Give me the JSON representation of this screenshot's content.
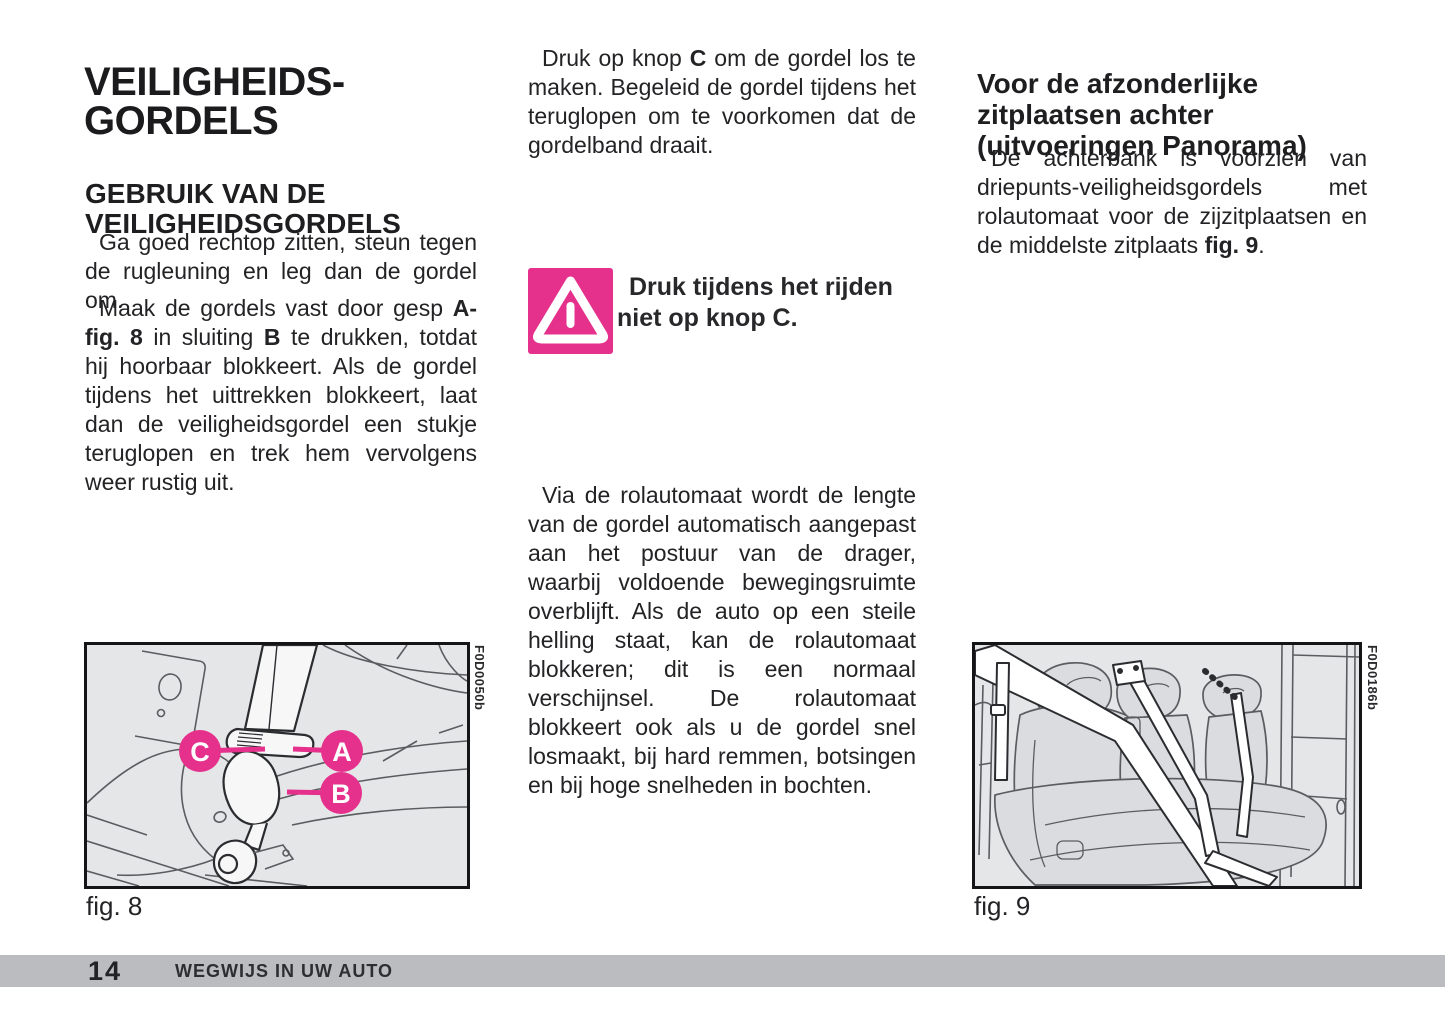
{
  "doc": {
    "left_column": {
      "title": "VEILIGHEIDS-\nGORDELS",
      "section_heading": "GEBRUIK VAN DE\nVEILIGHEIDSGORDELS",
      "paragraph_1": [
        {
          "t": "Ga goed rechtop zitten, steun tegen de rugleuning en leg dan de gordel om."
        }
      ],
      "paragraph_2": [
        {
          "t": "Maak de gordels vast door gesp "
        },
        {
          "t": "A-fig. 8",
          "b": true
        },
        {
          "t": " in sluiting "
        },
        {
          "t": "B",
          "b": true
        },
        {
          "t": " te drukken, totdat hij hoorbaar blokkeert. Als de gordel tijdens het uittrekken blokkeert, laat dan de veiligheidsgordel een stukje teruglopen en trek hem vervolgens weer rustig uit."
        }
      ]
    },
    "middle_column": {
      "paragraph_1": [
        {
          "t": "Druk op knop "
        },
        {
          "t": "C",
          "b": true
        },
        {
          "t": " om de gordel los te maken. Begeleid de gordel tijdens het teruglopen om te voorkomen dat de gordelband draait."
        }
      ],
      "warning_text": "Druk tijdens het rijden\nniet op knop C.",
      "paragraph_2": [
        {
          "t": "Via de rolautomaat wordt de lengte van de gordel automatisch aangepast aan het postuur van de drager, waarbij voldoende bewegingsruimte overblijft. Als de auto op een steile helling staat, kan de rolautomaat blokkeren; dit is een normaal verschijnsel. De rolautomaat blokkeert ook als u de gordel snel losmaakt, bij hard remmen, botsingen en bij hoge snelheden in bochten."
        }
      ]
    },
    "right_column": {
      "heading": "Voor de afzonderlijke\nzitplaatsen achter\n(uitvoeringen Panorama)",
      "paragraph_1": [
        {
          "t": "De achterbank is voorzien van driepunts-veiligheidsgordels met rolautomaat voor de zijzitplaatsen en de middelste zitplaats "
        },
        {
          "t": "fig. 9",
          "b": true
        },
        {
          "t": "."
        }
      ]
    },
    "figures": {
      "fig8": {
        "caption": "fig. 8",
        "code": "F0D0050b",
        "labels": {
          "c": "C",
          "a": "A",
          "b": "B"
        }
      },
      "fig9": {
        "caption": "fig. 9",
        "code": "F0D0186b"
      }
    },
    "footer": {
      "page_number": "14",
      "section_title": "WEGWIJS IN UW AUTO"
    },
    "colors": {
      "accent_magenta": "#E5308C",
      "figure_background": "#E5E6E8",
      "footer_bar": "#BBBCBF",
      "text": "#232326"
    }
  }
}
